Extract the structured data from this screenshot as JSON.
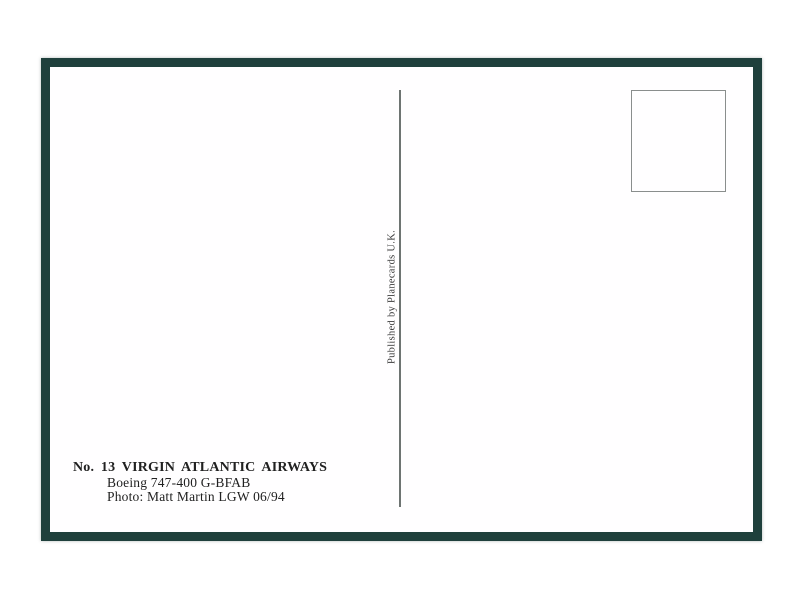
{
  "postcard": {
    "publisher_credit": "Published by Planecards U.K.",
    "caption": {
      "title": "No. 13 VIRGIN ATLANTIC AIRWAYS",
      "aircraft": "Boeing 747-400 G-BFAB",
      "photo_credit": "Photo: Matt Martin LGW 06/94"
    },
    "colors": {
      "border": "#1f403c",
      "divider": "#6e7472",
      "stamp_box_border": "#8a8e8d",
      "text": "#212121",
      "text_soft": "#3b3b3b"
    }
  }
}
